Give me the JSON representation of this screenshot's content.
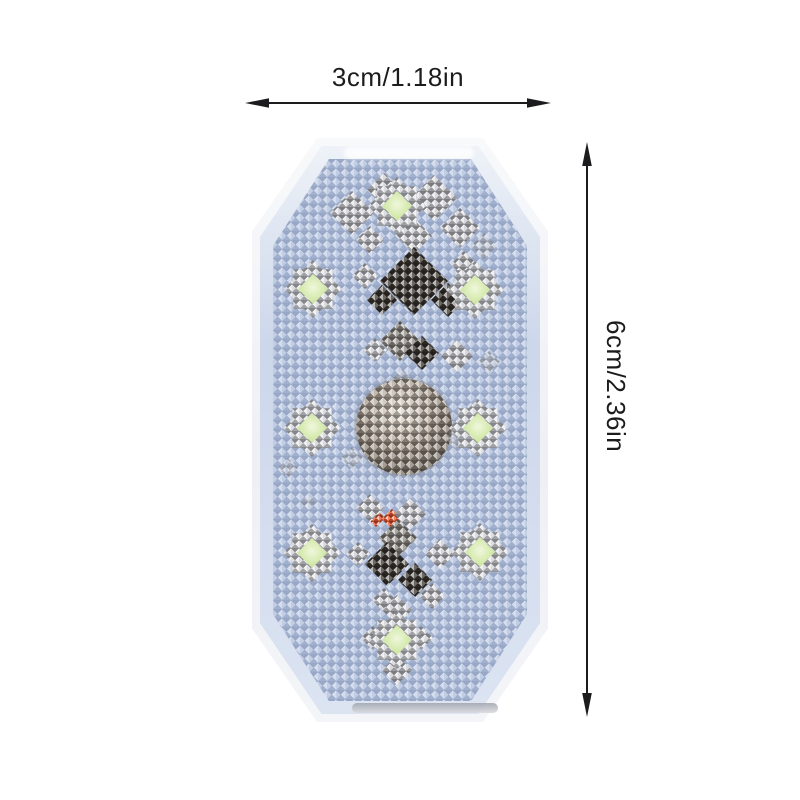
{
  "dimensions": {
    "width_label": "3cm/1.18in",
    "height_label": "6cm/2.36in"
  },
  "product": {
    "type": "octagonal-crystal-led-touch-light",
    "green_led_count": 8,
    "has_center_crystal_dome": true,
    "has_orange_indicator": true,
    "colors": {
      "face_blue": "#b7c5e0",
      "bevel_blue": "#ccd7ea",
      "housing_white": "#f7f8fa",
      "crystal_silver": "#cdced3",
      "crystal_smoke": "#8f8b85",
      "crystal_dark": "#3a3530",
      "dome_taupe": "#a99d90",
      "led_green": "#d4e9ab",
      "indicator_orange": "#f2552b",
      "annotation_black": "#1c1c1e"
    }
  }
}
